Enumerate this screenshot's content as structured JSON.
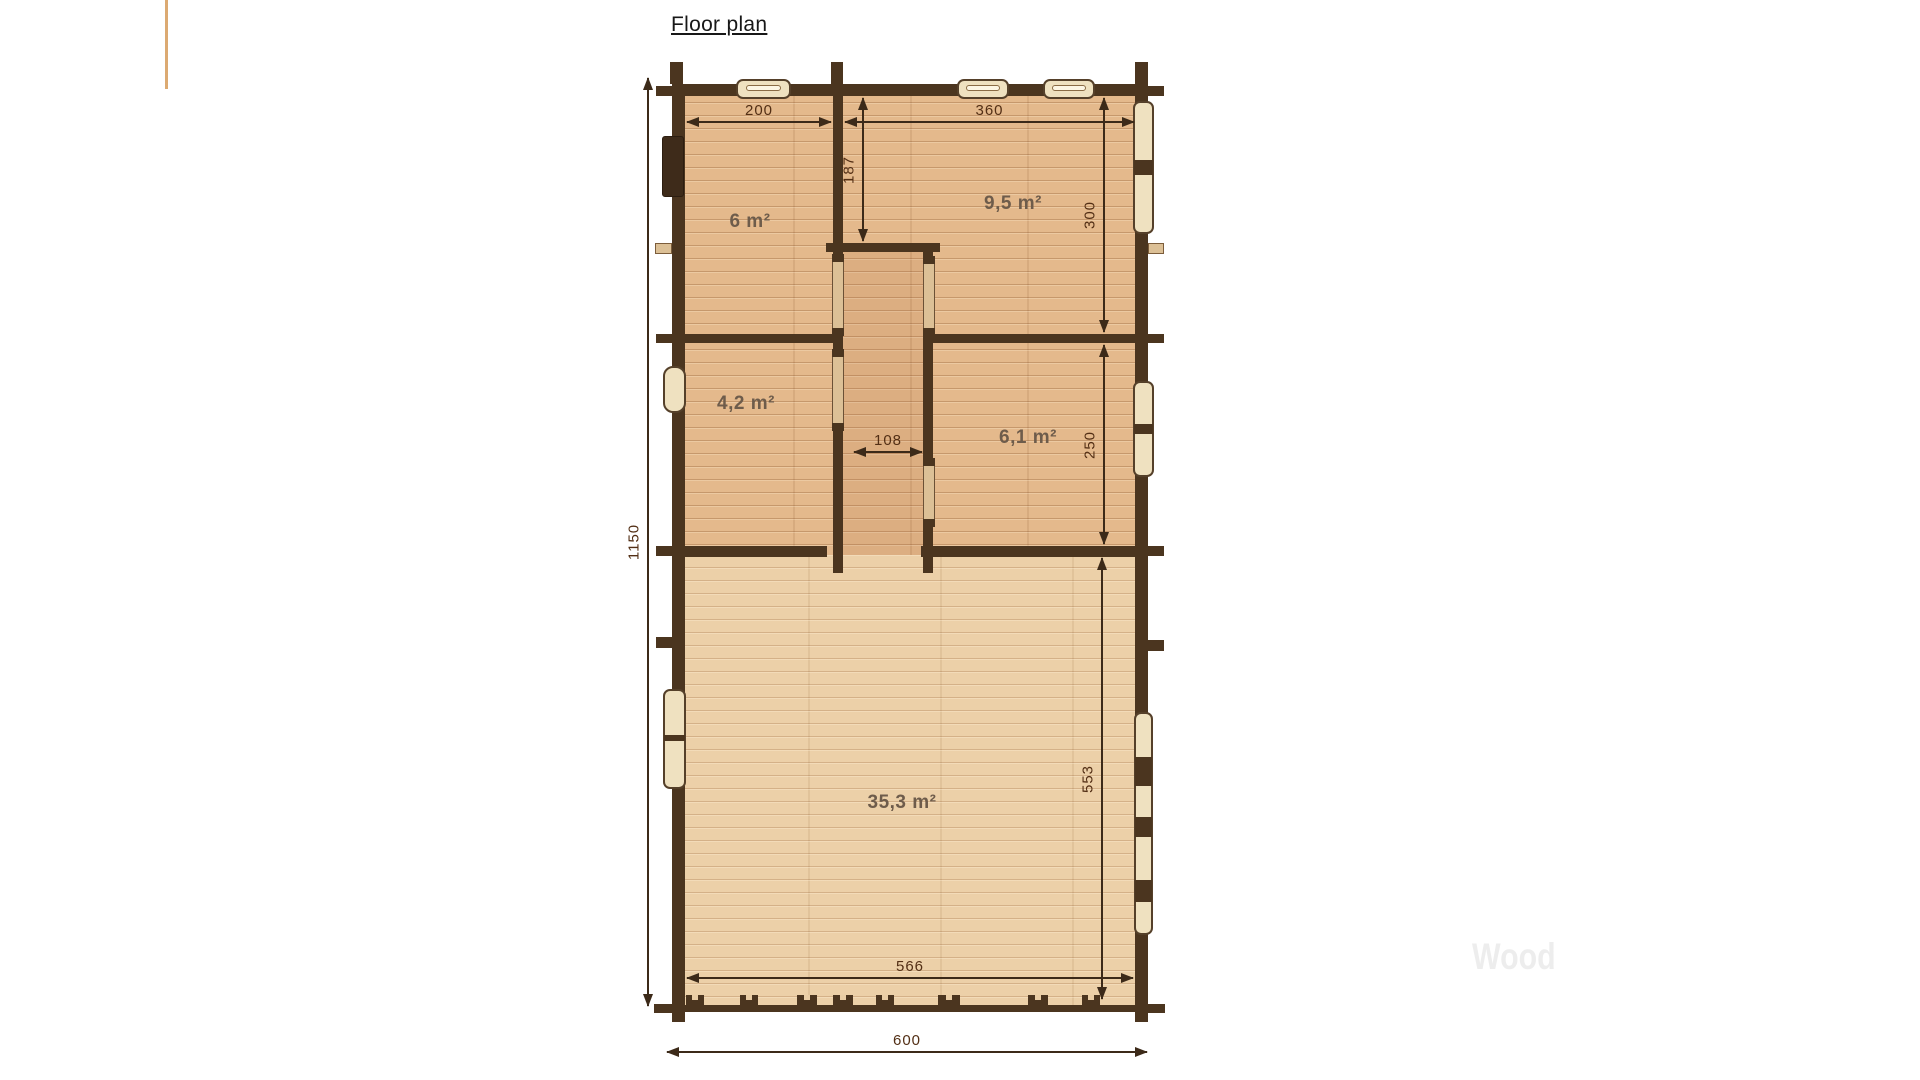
{
  "page": {
    "title": "Floor plan",
    "watermark": "Wood"
  },
  "rooms": [
    {
      "id": "room-top-left",
      "label": "6 m²"
    },
    {
      "id": "room-top-right",
      "label": "9,5 m²"
    },
    {
      "id": "room-mid-left",
      "label": "4,2 m²"
    },
    {
      "id": "room-mid-right",
      "label": "6,1 m²"
    },
    {
      "id": "living-room",
      "label": "35,3 m²"
    }
  ],
  "dimensions": {
    "top_left_width": "200",
    "top_right_width": "360",
    "hall_depth": "187",
    "right_upper_height": "300",
    "hall_width": "108",
    "right_mid_height": "250",
    "total_height": "1150",
    "living_room_height": "553",
    "inner_width": "566",
    "total_width": "600"
  },
  "colors": {
    "wall": "#4b351f",
    "floor_upper": "#e4b98c",
    "floor_lower": "#ecd0a8",
    "dimension_line": "#3c2a19",
    "dimension_text": "#532f15",
    "room_label": "#6e5c4b",
    "accent_line": "#dcaa72",
    "watermark": "#ededed"
  }
}
